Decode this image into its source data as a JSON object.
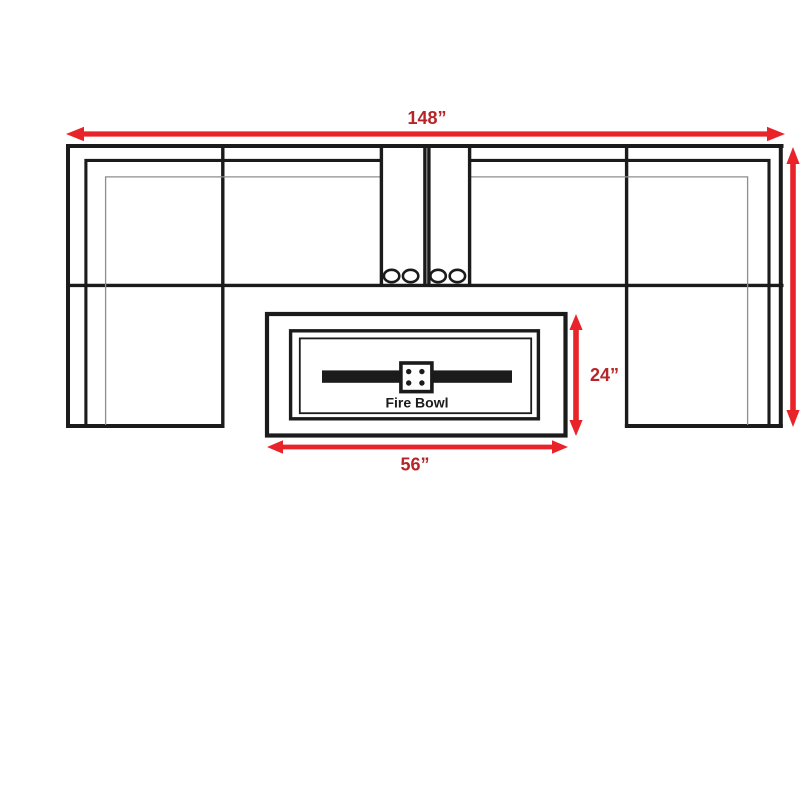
{
  "diagram": {
    "labels": {
      "overall_width": "148”",
      "fire_bowl_height": "24”",
      "fire_bowl_width": "56”",
      "fire_bowl": "Fire Bowl"
    },
    "colors": {
      "line": "#1b1b1b",
      "thin_line": "#8e8e8e",
      "arrow": "#e8242a",
      "dimension_text": "#b52529",
      "background": "#ffffff"
    }
  }
}
